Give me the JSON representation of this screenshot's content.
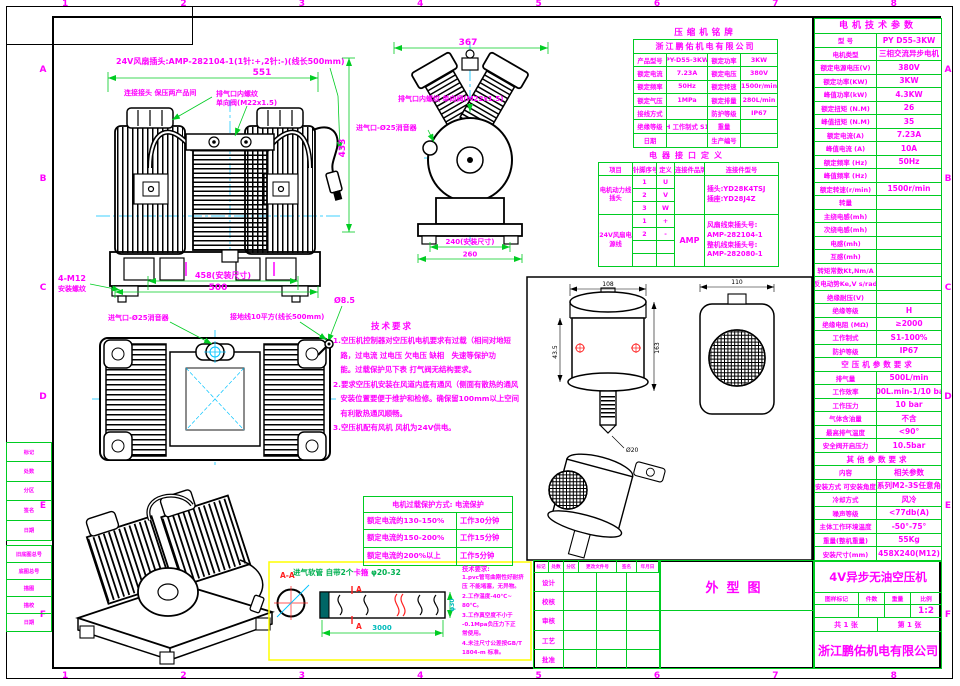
{
  "colors": {
    "accent_text": "#FF00FF",
    "table_border": "#00CC22",
    "centerline": "#00C3FF",
    "section_mark": "#FF2020",
    "hose_box": "#FFFF00"
  },
  "frame": {
    "zones": [
      "1",
      "2",
      "3",
      "4",
      "5",
      "6",
      "7",
      "8"
    ],
    "rows": [
      "A",
      "B",
      "C",
      "D",
      "E",
      "F"
    ]
  },
  "motor_table": {
    "title": "电机技术参数",
    "rows": [
      {
        "l": "型 号",
        "v": "PY D55-3KW"
      },
      {
        "l": "电机类型",
        "v": "三相交流异步电机"
      },
      {
        "l": "额定电源电压(V)",
        "v": "380V"
      },
      {
        "l": "额定功率(KW)",
        "v": "3KW"
      },
      {
        "l": "峰值功率(kW)",
        "v": "4.3KW"
      },
      {
        "l": "额定扭矩 (N.M)",
        "v": "26"
      },
      {
        "l": "峰值扭矩 (N.M)",
        "v": "35"
      },
      {
        "l": "额定电流(A)",
        "v": "7.23A"
      },
      {
        "l": "峰值电流 (A)",
        "v": "10A"
      },
      {
        "l": "额定频率 (Hz)",
        "v": "50Hz"
      },
      {
        "l": "峰值频率 (Hz)",
        "v": ""
      },
      {
        "l": "额定转速(r/min)",
        "v": "1500r/min"
      },
      {
        "l": "转量",
        "v": ""
      },
      {
        "l": "主绕电感(mh)",
        "v": ""
      },
      {
        "l": "次绕电感(mh)",
        "v": ""
      },
      {
        "l": "电感(mh)",
        "v": ""
      },
      {
        "l": "互感(mh)",
        "v": ""
      },
      {
        "l": "转矩常数Kt,Nm/A",
        "v": ""
      },
      {
        "l": "反电动势Ke,V s/rad",
        "v": ""
      },
      {
        "l": "绝缘耐压(V)",
        "v": ""
      },
      {
        "l": "绝缘等级",
        "v": "H"
      },
      {
        "l": "绝缘电阻 (MΩ)",
        "v": "≥2000"
      },
      {
        "l": "工作制式",
        "v": "S1-100%"
      },
      {
        "l": "防护等级",
        "v": "IP67"
      },
      {
        "h": "空压机参数要求"
      },
      {
        "l": "排气量",
        "v": "500L/min"
      },
      {
        "l": "工作效率",
        "v": "200L.min-1/10 bar"
      },
      {
        "l": "工作压力",
        "v": "10 bar"
      },
      {
        "l": "气体含油量",
        "v": "不含"
      },
      {
        "l": "最高排气温度",
        "v": "<90°"
      },
      {
        "l": "安全阀开启压力",
        "v": "10.5bar"
      },
      {
        "h": "其他参数要求"
      },
      {
        "l": "内容",
        "v": "相关参数"
      },
      {
        "l": "安装方式 可安装角度",
        "v": "全系列M2-3S任意角度"
      },
      {
        "l": "冷却方式",
        "v": "风冷"
      },
      {
        "l": "噪声等级",
        "v": "<77db(A)"
      },
      {
        "l": "主体工作环境温度",
        "v": "-50°-75°"
      },
      {
        "l": "重量(整机重量)",
        "v": "55Kg"
      },
      {
        "l": "安装尺寸(mm)",
        "v": "458X240(M12)"
      }
    ]
  },
  "nameplate": {
    "title": "压缩机铭牌",
    "company": "浙江鹏佑机电有限公司",
    "rows": [
      [
        "产品型号",
        "PY-D55-3KW",
        "额定功率",
        "3KW"
      ],
      [
        "额定电流",
        "7.23A",
        "额定电压",
        "380V"
      ],
      [
        "额定频率",
        "50Hz",
        "额定转速",
        "1500r/min"
      ],
      [
        "额定气压",
        "1MPa",
        "额定排量",
        "280L/min"
      ],
      [
        "接线方式",
        "",
        "防护等级",
        "IP67"
      ],
      [
        "绝缘等级",
        "H 工作制式 S1",
        "重量",
        ""
      ],
      [
        "日期",
        "",
        "生产编号",
        ""
      ]
    ]
  },
  "connector": {
    "title": "电器接口定义",
    "headers": [
      "项目",
      "针脚序号",
      "定义",
      "连接件品牌",
      "连接件型号"
    ],
    "groups": [
      {
        "name": "电机动力线插头",
        "pins": [
          [
            "1",
            "U"
          ],
          [
            "2",
            "V"
          ],
          [
            "3",
            "W"
          ]
        ],
        "brand": "",
        "model": "插头:YD28K4TSJ\n插座:YD28J4Z"
      },
      {
        "name": "24V风扇电源线",
        "pins": [
          [
            "1",
            "+"
          ],
          [
            "2",
            "-"
          ],
          [
            "",
            ""
          ],
          [
            "",
            ""
          ]
        ],
        "brand": "AMP",
        "model": "风扇线束插头号:\nAMP-282104-1\n整机线束插头号:\nAMP-282080-1"
      }
    ]
  },
  "tech_notes": {
    "title": "技术要求",
    "lines": [
      "1.空压机控制器对空压机电机要求有过载（相间对地短",
      "　路，过电流 过电压 欠电压 缺相　失速等保护功",
      "　能。过载保护见下表 打气阀无结构要求。",
      "2.要求空压机安装在风道内底有通风（侧面有散热的通风",
      "　安装位置要便于维护和检修。确保留100mm以上空间",
      "　有利散热通风顺畅。",
      "3.空压机配有风机 风机为24V供电。"
    ]
  },
  "overload": {
    "title": "电机过载保护方式: 电流保护",
    "rows": [
      [
        "额定电流的130-150%",
        "工作30分钟"
      ],
      [
        "额定电流的150-200%",
        "工作15分钟"
      ],
      [
        "额定电流的200%以上",
        "工作5分钟"
      ]
    ]
  },
  "hose_notes": {
    "title": "技术要求:",
    "lines": [
      "1.pvc管弯曲刚性好耐挤",
      "压 不能堵塞，无异物。",
      "2.工作温度-40℃~",
      "80℃。",
      "3.工作真空度不小于",
      "-0.1Mpa负压力下正",
      "常使用。",
      "4.未注尺寸公差按GB/T",
      "1804-m 标准。"
    ]
  },
  "annotations": {
    "fan_plug": "24V风扇插头:AMP-282104-1(1针:+,2针:-)(线长500mm)",
    "conn_note": "连接接头 保压两产品间",
    "cv1": "排气口内螺纹",
    "cv2": "单向阀(M22x1.5)",
    "cv_full": "排气口内螺纹 单向阀(M22x1.5)",
    "intake": "进气口-Ø25消音器",
    "ground": "接地线10平方(线长500mm)",
    "d551": "551",
    "d433": "433",
    "d367": "367",
    "d240": "240(安装尺寸)",
    "d260": "260",
    "d458": "458(安装尺寸)",
    "d500": "500",
    "bolt1": "4-M12",
    "bolt2": "安装螺纹",
    "hole": "Ø8.5",
    "f108": "108",
    "f163": "163",
    "f435": "43.5",
    "f20": "Ø20",
    "f110": "110",
    "aa": "A-A",
    "amark": "A",
    "hose_t1": "进气软管 自带2个",
    "hose_t2": "卡箍",
    "hose_t3": " φ20-32",
    "d3000": "3000",
    "dphi30": "φ30"
  },
  "title_block": {
    "product": "4V异步无油空压机",
    "drawing_name": "外型图",
    "headers": [
      "图样标记",
      "件数",
      "重量",
      "比例"
    ],
    "scale": "1:2",
    "sheet_total": "共 1 张",
    "sheet_no": "第 1 张",
    "company": "浙江鹏佑机电有限公司",
    "rev_headers": [
      "标记",
      "处数",
      "分区",
      "更改文件号",
      "签名",
      "年月日"
    ],
    "sig_rows": [
      "设计",
      "校核",
      "审核",
      "工艺",
      "批准"
    ]
  },
  "left_margin": {
    "block1": [
      "标记",
      "处数",
      "分区",
      "签名",
      "日期"
    ],
    "block2": [
      "旧底图总号",
      "底图总号",
      "描图",
      "描校",
      "日期"
    ]
  }
}
